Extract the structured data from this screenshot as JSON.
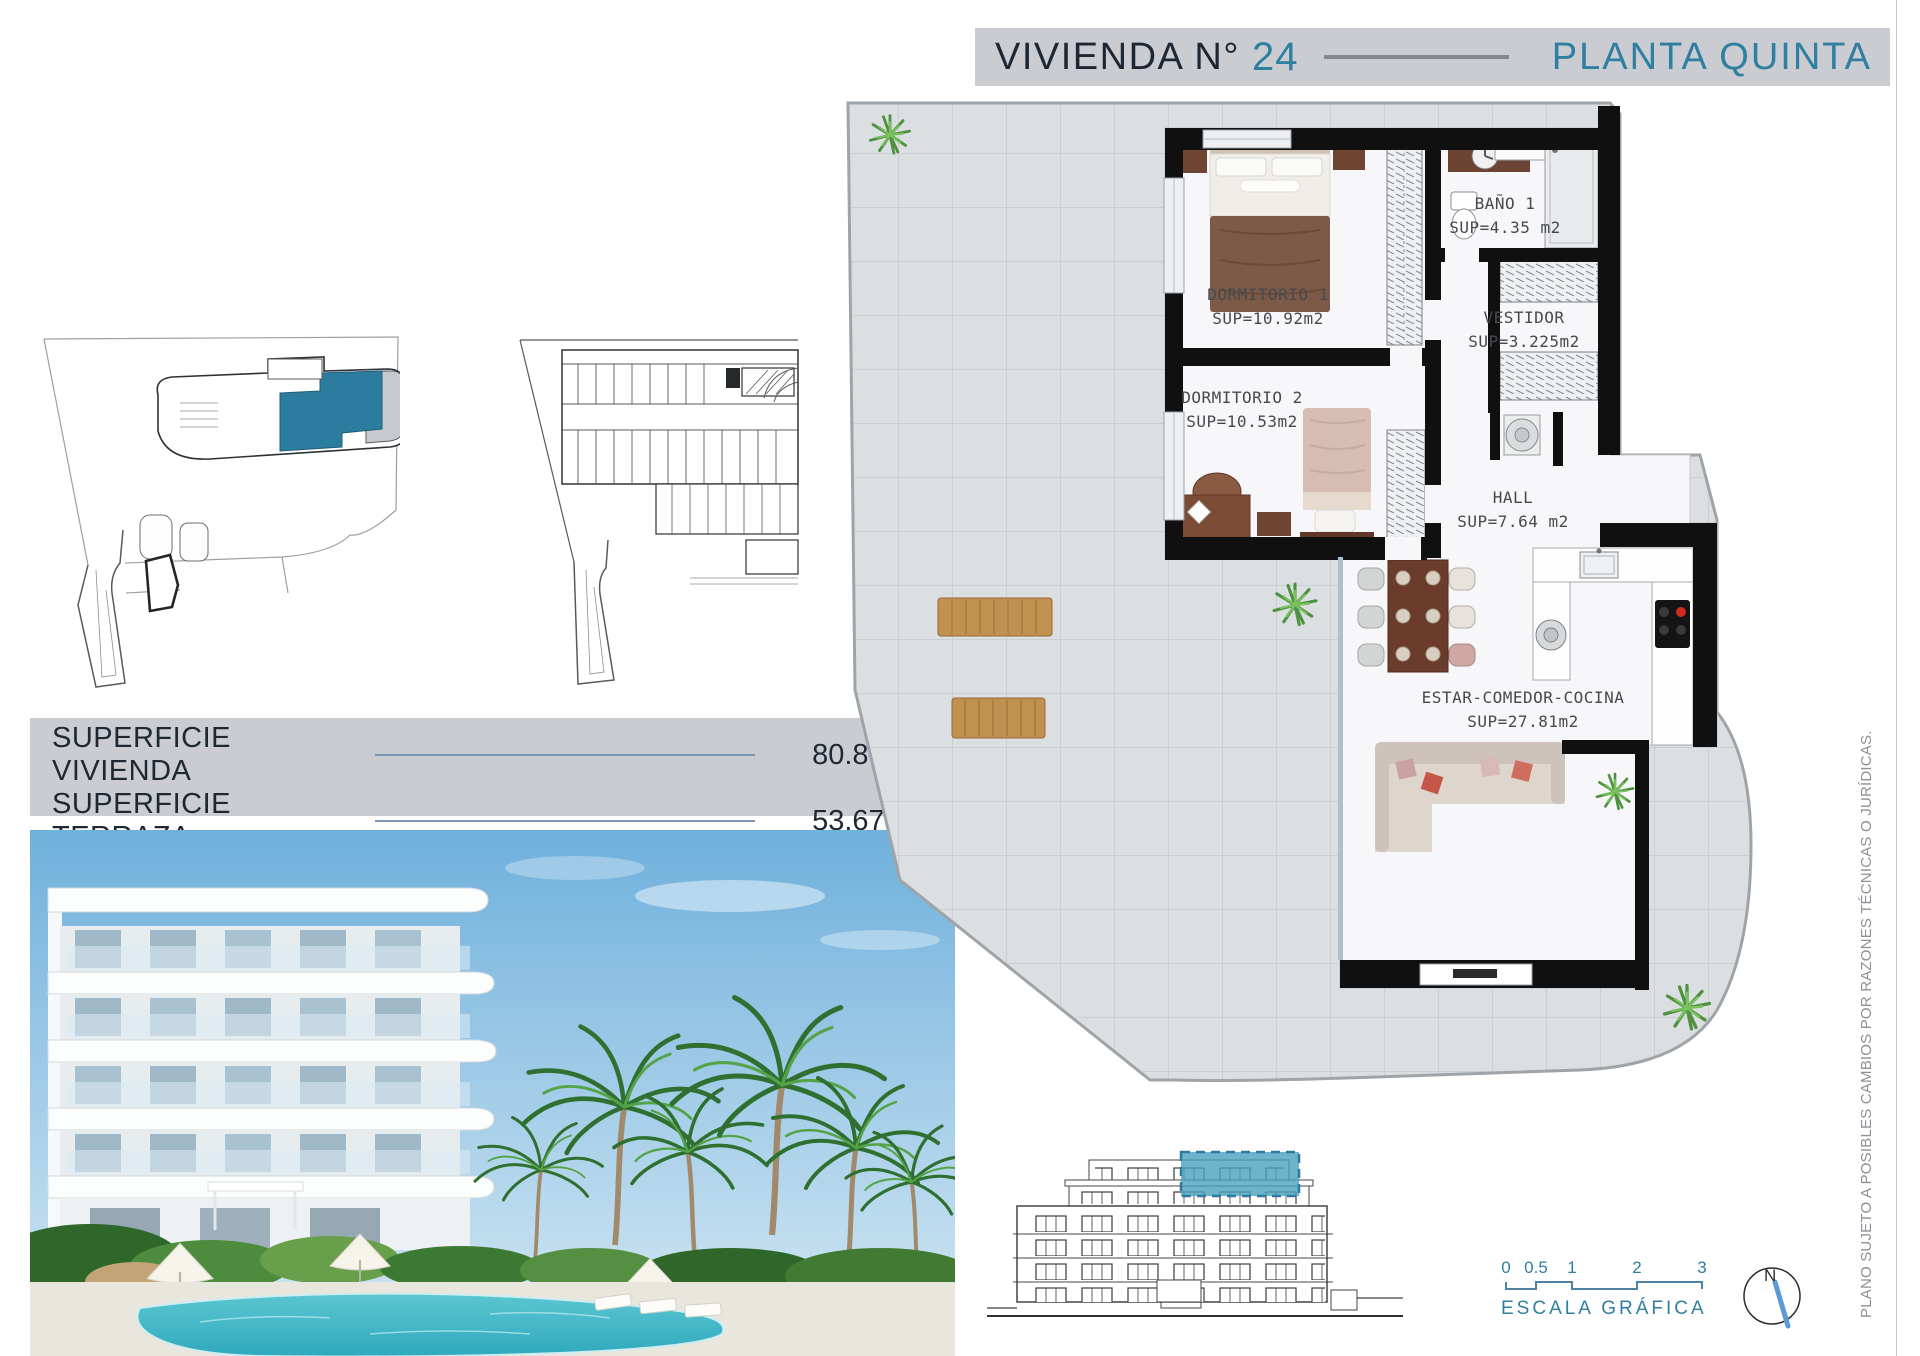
{
  "header": {
    "title": "VIVIENDA N°",
    "unit": "24",
    "floor": "PLANTA QUINTA"
  },
  "floor_plan": {
    "rooms": [
      {
        "name": "DORMITORIO 1",
        "sup": "SUP=10.92m2"
      },
      {
        "name": "BAÑO 1",
        "sup": "SUP=4.35 m2"
      },
      {
        "name": "VESTIDOR",
        "sup": "SUP=3.225m2"
      },
      {
        "name": "DORMITORIO 2",
        "sup": "SUP=10.53m2"
      },
      {
        "name": "HALL",
        "sup": "SUP=7.64 m2"
      },
      {
        "name": "ESTAR-COMEDOR-COCINA",
        "sup": "SUP=27.81m2"
      }
    ]
  },
  "areas": {
    "rows": [
      {
        "label": "SUPERFICIE VIVIENDA",
        "value": "80.86 m2"
      },
      {
        "label": "SUPERFICIE TERRAZA",
        "value": "53.67 m2"
      }
    ]
  },
  "scale_bar": {
    "ticks": [
      "0",
      "0.5",
      "1",
      "2",
      "3"
    ],
    "label": "ESCALA GRÁFICA"
  },
  "compass": {
    "north": "N"
  },
  "disclaimer": "PLANO SUJETO A POSIBLES CAMBIOS POR RAZONES TÉCNICAS O JURÍDICAS.",
  "colors": {
    "accent_teal": "#2f7fa0",
    "navy": "#1e2833",
    "bar_gray": "#caccd2",
    "highlight_teal": "#2b7c9e"
  }
}
